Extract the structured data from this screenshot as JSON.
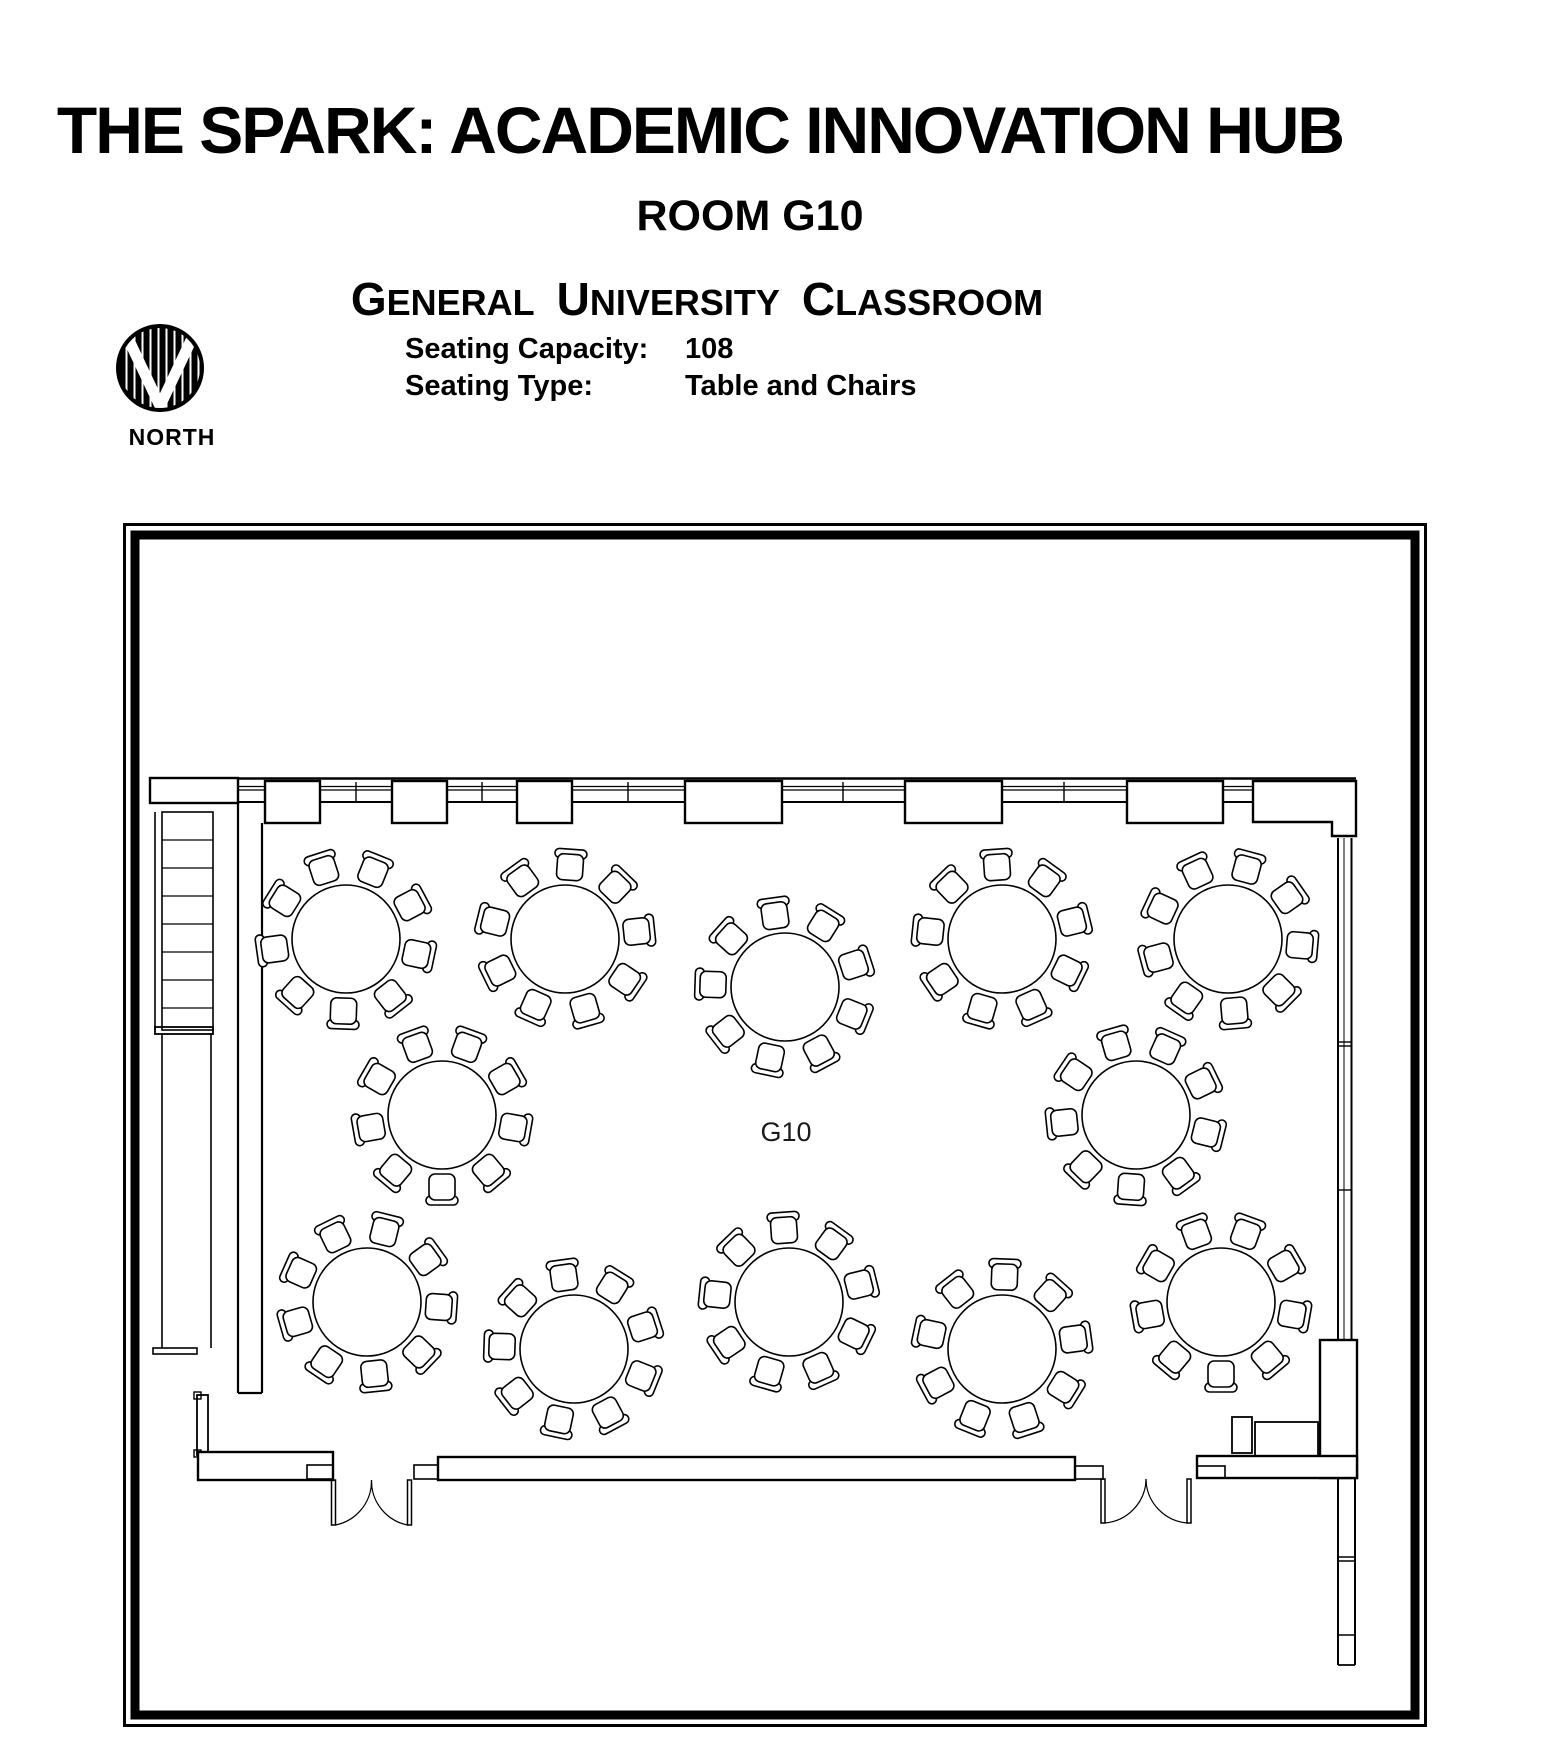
{
  "header": {
    "title": "THE SPARK: ACADEMIC INNOVATION HUB",
    "room": "ROOM G10",
    "classroom_type_words": [
      "GENERAL",
      "UNIVERSITY",
      "CLASSROOM"
    ],
    "seating_capacity_label": "Seating Capacity:",
    "seating_capacity_value": "108",
    "seating_type_label": "Seating Type:",
    "seating_type_value": "Table and Chairs",
    "north_label": "NORTH"
  },
  "plan": {
    "room_label": "G10",
    "tables_count": 12,
    "chairs_per_table": 9,
    "table_radius_px": 54,
    "chair_ring_radius_px": 72,
    "tables": [
      {
        "x": 223,
        "y": 416,
        "rot": 12
      },
      {
        "x": 442,
        "y": 416,
        "rot": -6
      },
      {
        "x": 662,
        "y": 464,
        "rot": 22
      },
      {
        "x": 879,
        "y": 416,
        "rot": -14
      },
      {
        "x": 1105,
        "y": 416,
        "rot": 5
      },
      {
        "x": 319,
        "y": 592,
        "rot": -30
      },
      {
        "x": 1013,
        "y": 592,
        "rot": 14
      },
      {
        "x": 244,
        "y": 779,
        "rot": 4
      },
      {
        "x": 451,
        "y": 826,
        "rot": -18
      },
      {
        "x": 666,
        "y": 779,
        "rot": 26
      },
      {
        "x": 879,
        "y": 826,
        "rot": -8
      },
      {
        "x": 1098,
        "y": 779,
        "rot": 10
      }
    ]
  },
  "colors": {
    "ink": "#000000",
    "paper": "#ffffff"
  }
}
